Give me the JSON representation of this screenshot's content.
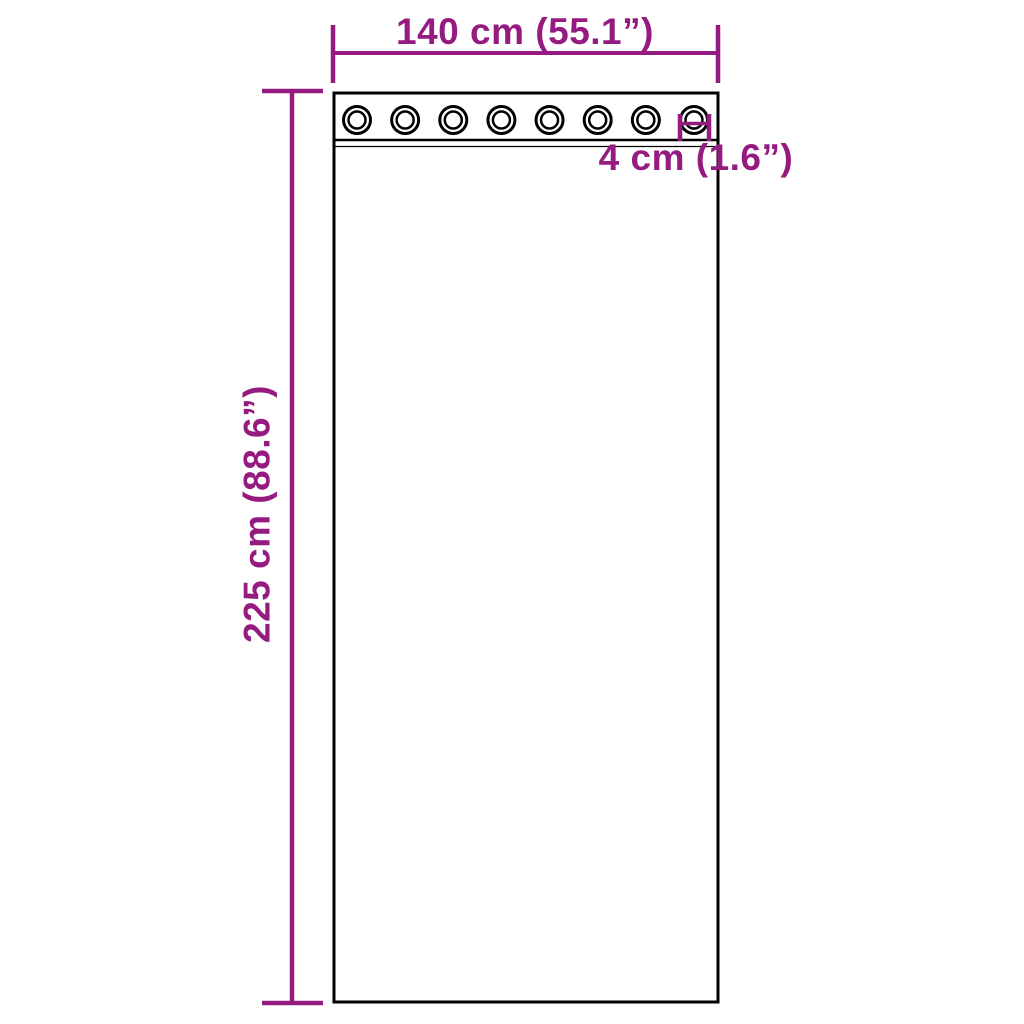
{
  "diagram": {
    "colors": {
      "background": "#ffffff",
      "line": "#000000",
      "accent": "#951b81"
    },
    "labels": {
      "width": "140 cm (55.1”)",
      "height": "225 cm (88.6”)",
      "grommet": "4 cm (1.6”)"
    },
    "grommets": {
      "count": 8
    }
  }
}
